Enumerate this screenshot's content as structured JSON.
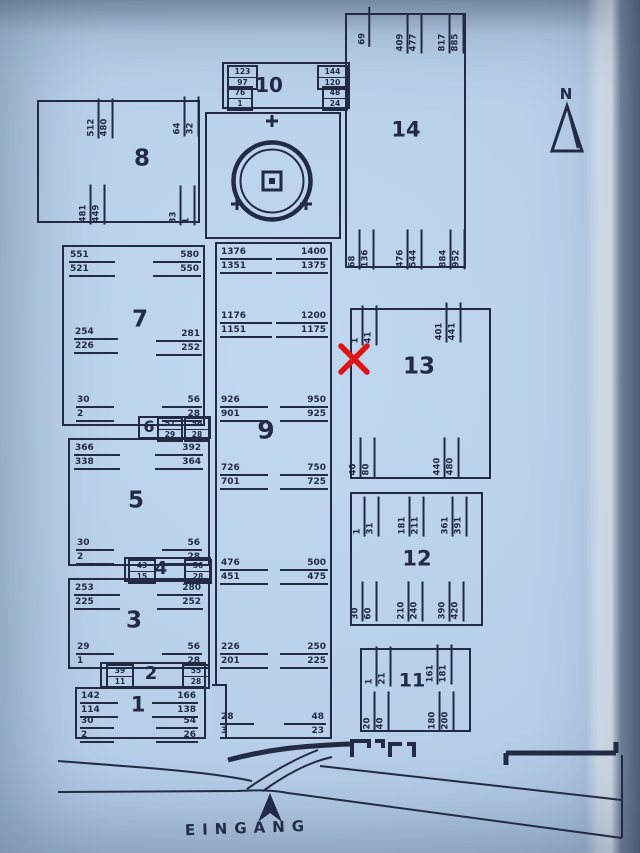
{
  "labels": {
    "entrance": "EINGANG",
    "north": "N"
  },
  "colors": {
    "paper": "#b6cee9",
    "ink": "#232a45",
    "marker": "#e01414"
  },
  "blocks": {
    "b1": {
      "label": "1",
      "tl": {
        "a": "142",
        "b": "114"
      },
      "tr": {
        "a": "166",
        "b": "138"
      },
      "bl": {
        "a": "30",
        "b": "2"
      },
      "br": {
        "a": "54",
        "b": "26"
      }
    },
    "b2": {
      "label": "2",
      "l": {
        "a": "39",
        "b": "11"
      },
      "r": {
        "a": "55",
        "b": "28"
      }
    },
    "b3": {
      "label": "3",
      "tl": {
        "a": "253",
        "b": "225"
      },
      "tr": {
        "a": "280",
        "b": "252"
      },
      "bl": {
        "a": "29",
        "b": "1"
      },
      "br": {
        "a": "56",
        "b": "28"
      }
    },
    "b4": {
      "label": "4",
      "l": {
        "a": "43",
        "b": "15"
      },
      "r": {
        "a": "56",
        "b": "28"
      }
    },
    "b5": {
      "label": "5",
      "tl": {
        "a": "366",
        "b": "338"
      },
      "tr": {
        "a": "392",
        "b": "364"
      },
      "bl": {
        "a": "30",
        "b": "2"
      },
      "br": {
        "a": "56",
        "b": "28"
      }
    },
    "b6": {
      "label": "6",
      "l": {
        "a": "57",
        "b": "29"
      },
      "r": {
        "a": "56",
        "b": "28"
      }
    },
    "b7": {
      "label": "7",
      "tl": {
        "a": "551",
        "b": "521"
      },
      "tr": {
        "a": "580",
        "b": "550"
      },
      "ml": {
        "a": "254",
        "b": "226"
      },
      "mr": {
        "a": "281",
        "b": "252"
      },
      "bl": {
        "a": "30",
        "b": "2"
      },
      "br": {
        "a": "56",
        "b": "28"
      }
    },
    "b8": {
      "label": "8",
      "tm": {
        "a": "512",
        "b": "480"
      },
      "tr": {
        "a": "64",
        "b": "32"
      },
      "bm": {
        "a": "481",
        "b": "449"
      },
      "br": {
        "a": "33",
        "b": "1"
      }
    },
    "b9": {
      "label": "9",
      "rows": [
        {
          "la": "1376",
          "lb": "1351",
          "ra": "1400",
          "rb": "1375"
        },
        {
          "la": "1176",
          "lb": "1151",
          "ra": "1200",
          "rb": "1175"
        },
        {
          "la": "926",
          "lb": "901",
          "ra": "950",
          "rb": "925"
        },
        {
          "la": "726",
          "lb": "701",
          "ra": "750",
          "rb": "725"
        },
        {
          "la": "476",
          "lb": "451",
          "ra": "500",
          "rb": "475"
        },
        {
          "la": "226",
          "lb": "201",
          "ra": "250",
          "rb": "225"
        },
        {
          "la": "28",
          "lb": "3",
          "ra": "48",
          "rb": "23"
        }
      ]
    },
    "b10": {
      "label": "10",
      "l1": {
        "a": "123",
        "b": "97"
      },
      "l2": {
        "a": "76",
        "b": "1"
      },
      "r1": {
        "a": "144",
        "b": "120"
      },
      "r2": {
        "a": "48",
        "b": "24"
      }
    },
    "b11": {
      "label": "11",
      "tl": {
        "a": "1",
        "b": "21"
      },
      "tr": {
        "a": "161",
        "b": "181"
      },
      "bl": {
        "a": "20",
        "b": "40"
      },
      "br": {
        "a": "180",
        "b": "200"
      }
    },
    "b12": {
      "label": "12",
      "t1": {
        "a": "1",
        "b": "31"
      },
      "t2": {
        "a": "181",
        "b": "211"
      },
      "t3": {
        "a": "361",
        "b": "391"
      },
      "b1": {
        "a": "30",
        "b": "60"
      },
      "b2": {
        "a": "210",
        "b": "240"
      },
      "b3": {
        "a": "390",
        "b": "420"
      }
    },
    "b13": {
      "label": "13",
      "tl": {
        "a": "1",
        "b": "41"
      },
      "tr": {
        "a": "401",
        "b": "441"
      },
      "bl": {
        "a": "40",
        "b": "80"
      },
      "br": {
        "a": "440",
        "b": "480"
      }
    },
    "b14": {
      "label": "14",
      "t1": {
        "a": "69"
      },
      "t2": {
        "a": "409",
        "b": "477"
      },
      "t3": {
        "a": "817",
        "b": "885"
      },
      "b1": {
        "a": "68",
        "b": "136"
      },
      "b2": {
        "a": "476",
        "b": "544"
      },
      "b3": {
        "a": "884",
        "b": "952"
      }
    }
  }
}
